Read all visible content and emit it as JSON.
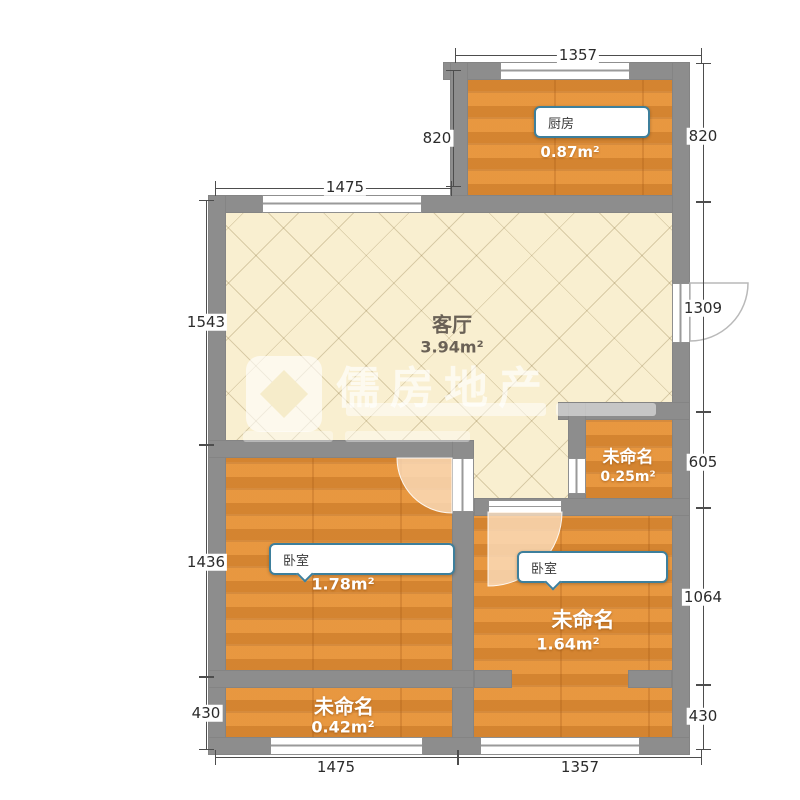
{
  "plan": {
    "type": "apartment-floor-plan",
    "watermark": {
      "brand": "儒房地产"
    },
    "colors": {
      "wall": "#8d8d8d",
      "wood_floor": "#e2913c",
      "tile_floor": "#f9efd0",
      "callout_border": "#3d7f9c"
    },
    "rooms": {
      "kitchen": {
        "name": "厨房",
        "area": "0.87m²"
      },
      "living": {
        "name": "客厅",
        "area": "3.94m²"
      },
      "storage": {
        "name": "未命名",
        "area": "0.25m²"
      },
      "bedroom_left": {
        "name": "卧室",
        "area": "1.78m²"
      },
      "bedroom_right": {
        "tag": "卧室",
        "name": "未命名",
        "area": "1.64m²"
      },
      "balcony": {
        "name": "未命名",
        "area": "0.42m²"
      }
    },
    "dims": {
      "top": "1357",
      "living_top": "1475",
      "kitchen_left": "820",
      "left_upper": "1543",
      "left_mid": "1436",
      "left_lower": "430",
      "right_kitchen": "820",
      "right_upper": "1309",
      "right_mid": "605",
      "right_lower": "1064",
      "right_bottom": "430",
      "bottom_left": "1475",
      "bottom_right": "1357"
    }
  }
}
